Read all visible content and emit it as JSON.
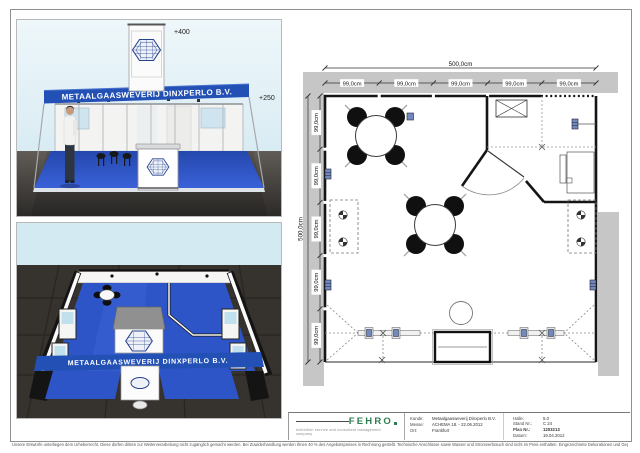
{
  "document": {
    "footer_disclaimer": "Unsere Entwürfe unterliegen dem Urheberrecht. Diese dürfen dritten zur Weiterverarbeitung nicht zugänglich gemacht werden. Bei Zuwiderhandlung werden Ihnen 40 % des Angebotspreises in Rechnung gestellt. Technische Anschlüsse sowie Wasser und Stromverbrauch sind nicht im Preis enthalten. Eingezeichnete Dekorationen und Gegenstände die nicht in der Leistungsbeschreibung enthalten sind, gehören nicht zum Lieferumfang. Änderungen durch die Messe bleiben vorbehalten."
  },
  "front_view": {
    "fascia_text": "METAALGAASWEVERIJ DINXPERLO B.V.",
    "tower_height_label": "+400",
    "fascia_height_label": "+250"
  },
  "top_view": {
    "fascia_text": "METAALGAASWEVERIJ DINXPERLO B.V."
  },
  "floor_plan": {
    "total_width_label": "500,0cm",
    "total_depth_label": "500,0cm",
    "top_segment_labels": [
      "99,0cm",
      "99,0cm",
      "99,0cm",
      "99,0cm",
      "99,0cm"
    ],
    "left_segment_labels": [
      "99,0cm",
      "99,0cm",
      "99,0cm",
      "99,0cm",
      "99,0cm"
    ]
  },
  "title_block": {
    "company_logo_text": "FEHRO",
    "company_tagline": "exhibition service and consultant management company",
    "client": {
      "label": "Kunde:",
      "value": "Metaalgaasweverij Dinxperlo B.V."
    },
    "fair": {
      "label": "Messe:",
      "value": "ACHEMA 18. - 22.06.2012"
    },
    "city": {
      "label": "Ort:",
      "value": "Frankfurt"
    },
    "hall": {
      "label": "Halle:",
      "value": "5.0"
    },
    "stand_no": {
      "label": "Stand Nr.:",
      "value": "C 24"
    },
    "plan_no": {
      "label": "Plan Nr.:",
      "value": "1203213"
    },
    "date": {
      "label": "Datum:",
      "value": "19.04.2012"
    }
  }
}
